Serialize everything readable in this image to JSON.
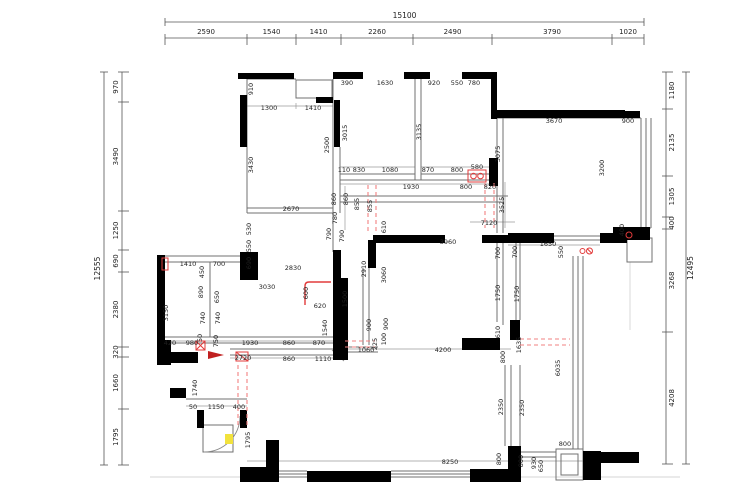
{
  "title": "apartment-floor-plan",
  "colors": {
    "wall": "#000000",
    "line": "#707070",
    "dimline": "#9a9a9a",
    "dim": "#1f1f1f",
    "red": "#e23b3b",
    "red_dash": "#f28080",
    "yellow": "#f2e23c"
  },
  "plan": {
    "chains": [
      {
        "name": "top",
        "dir": "h",
        "rail": 38,
        "voff": -4,
        "trail": 22,
        "toff": -4,
        "ticks": [
          165,
          247,
          296,
          341,
          413,
          492,
          612,
          644
        ],
        "vals": [
          "2590",
          "1540",
          "1410",
          "2260",
          "2490",
          "3790",
          "1020"
        ],
        "total": "15100"
      },
      {
        "name": "left",
        "dir": "v",
        "rail": 122,
        "voff": -4,
        "trail": 104,
        "toff": -4,
        "ticks": [
          72,
          102,
          211,
          250,
          272,
          347,
          357,
          409,
          465
        ],
        "vals": [
          "970",
          "3490",
          "1250",
          "690",
          "2380",
          "320",
          "1660",
          "1795"
        ],
        "total": "12555"
      },
      {
        "name": "right",
        "dir": "v",
        "rail": 666,
        "voff": 8,
        "trail": 686,
        "toff": 7,
        "ticks": [
          72,
          109,
          176,
          217,
          229,
          332,
          464
        ],
        "vals": [
          "1180",
          "2135",
          "1305",
          "400",
          "3268",
          "4208"
        ],
        "total": "12495"
      }
    ],
    "labels": [
      {
        "t": "910",
        "x": 253,
        "y": 89,
        "v": 1
      },
      {
        "t": "1300",
        "x": 269,
        "y": 110,
        "v": 0
      },
      {
        "t": "1410",
        "x": 313,
        "y": 110,
        "v": 0
      },
      {
        "t": "2500",
        "x": 329,
        "y": 145,
        "v": 1
      },
      {
        "t": "3430",
        "x": 253,
        "y": 165,
        "v": 1
      },
      {
        "t": "2670",
        "x": 291,
        "y": 211,
        "v": 0
      },
      {
        "t": "530",
        "x": 251,
        "y": 229,
        "v": 1
      },
      {
        "t": "550",
        "x": 251,
        "y": 246,
        "v": 1
      },
      {
        "t": "690",
        "x": 251,
        "y": 263,
        "v": 1
      },
      {
        "t": "860",
        "x": 336,
        "y": 199,
        "v": 1
      },
      {
        "t": "860",
        "x": 348,
        "y": 199,
        "v": 1
      },
      {
        "t": "780",
        "x": 337,
        "y": 218,
        "v": 1
      },
      {
        "t": "790",
        "x": 331,
        "y": 234,
        "v": 1
      },
      {
        "t": "790",
        "x": 344,
        "y": 236,
        "v": 1
      },
      {
        "t": "390",
        "x": 347,
        "y": 85,
        "v": 0
      },
      {
        "t": "1630",
        "x": 385,
        "y": 85,
        "v": 0
      },
      {
        "t": "3015",
        "x": 347,
        "y": 133,
        "v": 1
      },
      {
        "t": "110",
        "x": 344,
        "y": 172,
        "v": 0
      },
      {
        "t": "830",
        "x": 359,
        "y": 172,
        "v": 0
      },
      {
        "t": "1080",
        "x": 390,
        "y": 172,
        "v": 0
      },
      {
        "t": "920",
        "x": 434,
        "y": 85,
        "v": 0
      },
      {
        "t": "550",
        "x": 457,
        "y": 85,
        "v": 0
      },
      {
        "t": "780",
        "x": 474,
        "y": 85,
        "v": 0
      },
      {
        "t": "3135",
        "x": 421,
        "y": 132,
        "v": 1
      },
      {
        "t": "870",
        "x": 428,
        "y": 172,
        "v": 0
      },
      {
        "t": "800",
        "x": 457,
        "y": 172,
        "v": 0
      },
      {
        "t": "580",
        "x": 477,
        "y": 169,
        "v": 0
      },
      {
        "t": "1930",
        "x": 411,
        "y": 189,
        "v": 0
      },
      {
        "t": "800",
        "x": 466,
        "y": 189,
        "v": 0
      },
      {
        "t": "820",
        "x": 490,
        "y": 189,
        "v": 0
      },
      {
        "t": "855",
        "x": 359,
        "y": 204,
        "v": 1
      },
      {
        "t": "855",
        "x": 372,
        "y": 206,
        "v": 1
      },
      {
        "t": "610",
        "x": 386,
        "y": 227,
        "v": 1
      },
      {
        "t": "3525",
        "x": 504,
        "y": 205,
        "v": 1
      },
      {
        "t": "7120",
        "x": 489,
        "y": 225,
        "v": 0
      },
      {
        "t": "3670",
        "x": 554,
        "y": 123,
        "v": 0
      },
      {
        "t": "900",
        "x": 628,
        "y": 123,
        "v": 0
      },
      {
        "t": "3075",
        "x": 500,
        "y": 154,
        "v": 1
      },
      {
        "t": "3200",
        "x": 604,
        "y": 168,
        "v": 1
      },
      {
        "t": "400",
        "x": 624,
        "y": 230,
        "v": 1
      },
      {
        "t": "1650",
        "x": 548,
        "y": 246,
        "v": 0
      },
      {
        "t": "550",
        "x": 563,
        "y": 252,
        "v": 1
      },
      {
        "t": "1410",
        "x": 188,
        "y": 266,
        "v": 0
      },
      {
        "t": "450",
        "x": 204,
        "y": 272,
        "v": 1
      },
      {
        "t": "700",
        "x": 219,
        "y": 266,
        "v": 0
      },
      {
        "t": "890",
        "x": 203,
        "y": 292,
        "v": 1
      },
      {
        "t": "650",
        "x": 219,
        "y": 297,
        "v": 1
      },
      {
        "t": "740",
        "x": 205,
        "y": 318,
        "v": 1
      },
      {
        "t": "740",
        "x": 220,
        "y": 318,
        "v": 1
      },
      {
        "t": "3150",
        "x": 168,
        "y": 313,
        "v": 1
      },
      {
        "t": "2830",
        "x": 293,
        "y": 270,
        "v": 0
      },
      {
        "t": "3030",
        "x": 267,
        "y": 289,
        "v": 0
      },
      {
        "t": "600",
        "x": 308,
        "y": 293,
        "v": 1
      },
      {
        "t": "620",
        "x": 320,
        "y": 308,
        "v": 0
      },
      {
        "t": "1540",
        "x": 327,
        "y": 328,
        "v": 1
      },
      {
        "t": "1500",
        "x": 347,
        "y": 299,
        "v": 1
      },
      {
        "t": "420",
        "x": 170,
        "y": 345,
        "v": 0
      },
      {
        "t": "980",
        "x": 192,
        "y": 345,
        "v": 0
      },
      {
        "t": "50",
        "x": 202,
        "y": 338,
        "v": 1
      },
      {
        "t": "750",
        "x": 218,
        "y": 341,
        "v": 1
      },
      {
        "t": "1930",
        "x": 250,
        "y": 345,
        "v": 0
      },
      {
        "t": "860",
        "x": 289,
        "y": 345,
        "v": 0
      },
      {
        "t": "870",
        "x": 319,
        "y": 345,
        "v": 0
      },
      {
        "t": "2720",
        "x": 243,
        "y": 360,
        "v": 0
      },
      {
        "t": "860",
        "x": 289,
        "y": 361,
        "v": 0
      },
      {
        "t": "1110",
        "x": 323,
        "y": 361,
        "v": 0
      },
      {
        "t": "1740",
        "x": 197,
        "y": 388,
        "v": 1
      },
      {
        "t": "50",
        "x": 193,
        "y": 409,
        "v": 0
      },
      {
        "t": "1150",
        "x": 216,
        "y": 409,
        "v": 0
      },
      {
        "t": "400",
        "x": 239,
        "y": 409,
        "v": 0
      },
      {
        "t": "1795",
        "x": 250,
        "y": 440,
        "v": 1
      },
      {
        "t": "3960",
        "x": 448,
        "y": 244,
        "v": 0
      },
      {
        "t": "2910",
        "x": 366,
        "y": 269,
        "v": 1
      },
      {
        "t": "3060",
        "x": 386,
        "y": 275,
        "v": 1
      },
      {
        "t": "700",
        "x": 500,
        "y": 253,
        "v": 1
      },
      {
        "t": "700",
        "x": 517,
        "y": 252,
        "v": 1
      },
      {
        "t": "1750",
        "x": 500,
        "y": 293,
        "v": 1
      },
      {
        "t": "1750",
        "x": 519,
        "y": 294,
        "v": 1
      },
      {
        "t": "610",
        "x": 500,
        "y": 332,
        "v": 1
      },
      {
        "t": "1635",
        "x": 521,
        "y": 345,
        "v": 1
      },
      {
        "t": "6035",
        "x": 560,
        "y": 368,
        "v": 1
      },
      {
        "t": "900",
        "x": 371,
        "y": 325,
        "v": 1
      },
      {
        "t": "900",
        "x": 388,
        "y": 324,
        "v": 1
      },
      {
        "t": "100",
        "x": 386,
        "y": 339,
        "v": 1
      },
      {
        "t": "225",
        "x": 377,
        "y": 344,
        "v": 1
      },
      {
        "t": "1060",
        "x": 366,
        "y": 352,
        "v": 0
      },
      {
        "t": "4200",
        "x": 443,
        "y": 352,
        "v": 0
      },
      {
        "t": "800",
        "x": 505,
        "y": 357,
        "v": 1
      },
      {
        "t": "2350",
        "x": 503,
        "y": 407,
        "v": 1
      },
      {
        "t": "2350",
        "x": 524,
        "y": 408,
        "v": 1
      },
      {
        "t": "800",
        "x": 501,
        "y": 459,
        "v": 1
      },
      {
        "t": "800",
        "x": 523,
        "y": 461,
        "v": 1
      },
      {
        "t": "8250",
        "x": 450,
        "y": 464,
        "v": 0
      },
      {
        "t": "930",
        "x": 536,
        "y": 463,
        "v": 1
      },
      {
        "t": "650",
        "x": 543,
        "y": 466,
        "v": 1
      },
      {
        "t": "800",
        "x": 565,
        "y": 446,
        "v": 0
      }
    ]
  }
}
